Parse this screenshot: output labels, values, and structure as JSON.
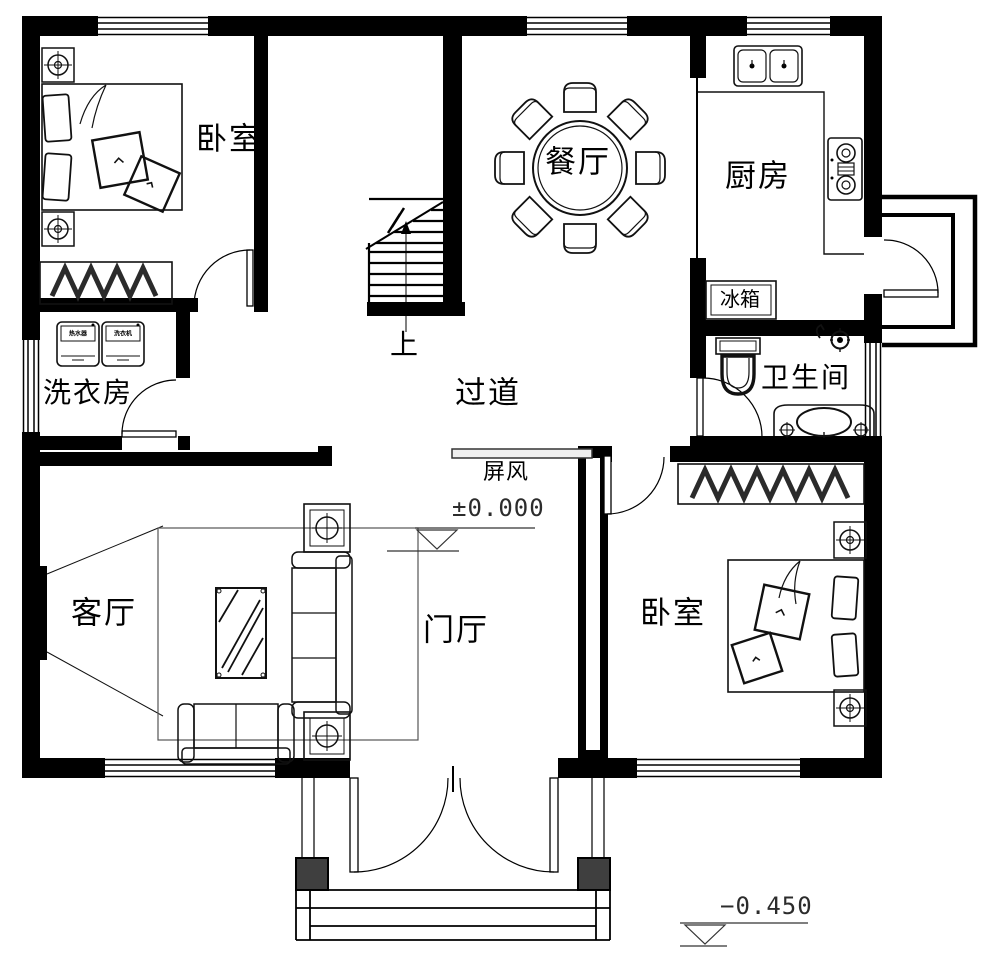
{
  "plan": {
    "rooms": {
      "bedroom_top_left": "卧室",
      "dining": "餐厅",
      "kitchen": "厨房",
      "laundry": "洗衣房",
      "corridor": "过道",
      "bathroom": "卫生间",
      "living": "客厅",
      "foyer": "门厅",
      "bedroom_bottom_right": "卧室"
    },
    "annotations": {
      "stairs_up": "上",
      "screen": "屏风",
      "fridge": "冰箱",
      "level_floor": "±0.000",
      "level_outdoor": "−0.450",
      "appliance_left": "热水器",
      "appliance_right": "洗衣机"
    },
    "colors": {
      "line": "#000000",
      "column_fill": "#3f3f3f",
      "background": "#ffffff"
    }
  }
}
